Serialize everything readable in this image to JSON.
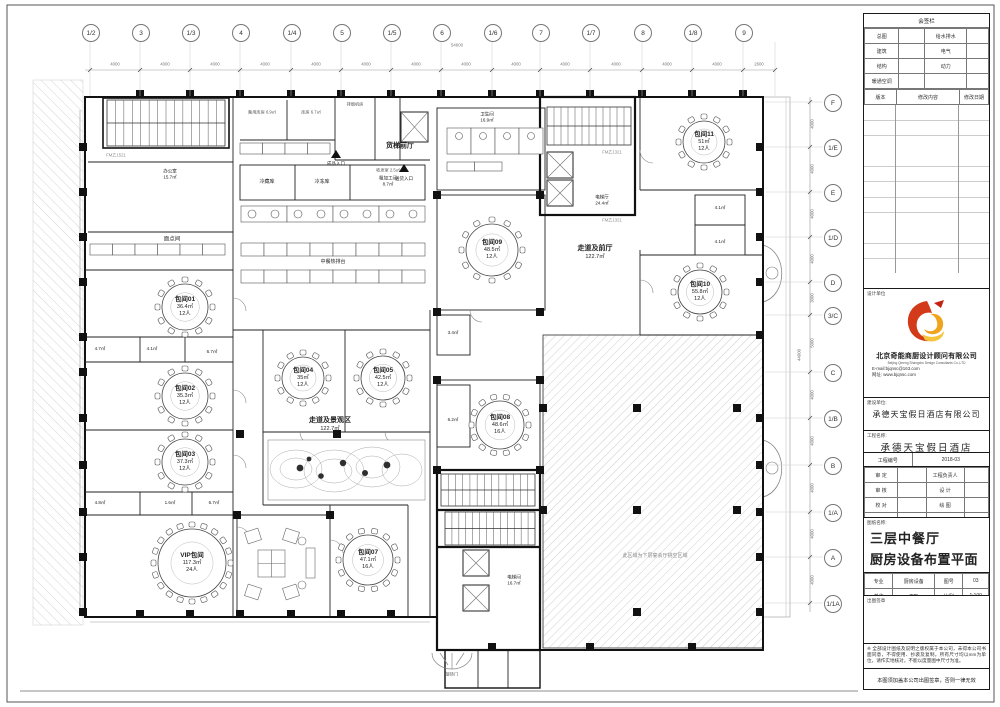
{
  "titleblock": {
    "sign": {
      "title": "会签栏",
      "rows": [
        [
          "总图",
          "给水排水"
        ],
        [
          "建筑",
          "电气"
        ],
        [
          "结构",
          "动力"
        ],
        [
          "暖通空调",
          ""
        ]
      ],
      "rev": [
        "版本",
        "修改内容",
        "修改日期"
      ]
    },
    "firm": {
      "label": "设计单位",
      "name_cn": "北京奇能商厨设计顾问有限公司",
      "name_en": "Beijing Qineng Shangchu Design Consultants Co.,LTD",
      "email": "E-mail:bjqnsc@163.com",
      "website": "网址: www.bjqnsc.com"
    },
    "client": {
      "label": "建设单位:",
      "value": "承德天宝假日酒店有限公司"
    },
    "project": {
      "label": "工程名称:",
      "value": "承德天宝假日酒店"
    },
    "project_no": {
      "label": "工程编号",
      "value": "2018-03"
    },
    "approval": {
      "rows": [
        {
          "l1": "审  定",
          "v1": "",
          "l2": "工程负责人",
          "v2": ""
        },
        {
          "l1": "审  核",
          "v1": "",
          "l2": "设  计",
          "v2": ""
        },
        {
          "l1": "校  对",
          "v1": "",
          "l2": "绘  图",
          "v2": ""
        },
        {
          "l1": "专业负责人",
          "v1": "",
          "l2": "日期",
          "v2": "2018.06.12"
        }
      ]
    },
    "sheet_name": {
      "label": "图纸名称:",
      "line1": "三层中餐厅",
      "line2": "厨房设备布置平面图"
    },
    "meta": {
      "specialty_label": "专业",
      "specialty": "厨房设备",
      "sheet_no_label": "图号",
      "sheet_no": "03",
      "unit_label": "单位",
      "unit": "mm",
      "scale_label": "比例",
      "scale": "1:100"
    },
    "stamp_label": "出图签章",
    "copyright_note": "※ 全部设计图纸及说明之版权属于本公司，未得本公司书面同意，不得使用、抄袭及复制。所有尺寸均以mm为单位，请作实地核对，不能以度量图中尺寸为准。",
    "validity_note": "本图须加盖本公司出图签章，否则一律无效"
  },
  "grid": {
    "top_bubbles": [
      "1/2",
      "3",
      "1/3",
      "4",
      "1/4",
      "5",
      "1/5",
      "6",
      "1/6",
      "7",
      "1/7",
      "8",
      "1/8",
      "9"
    ],
    "top_dims": [
      "4000",
      "4000",
      "4000",
      "4000",
      "4000",
      "4000",
      "4000",
      "4000",
      "4000",
      "4000",
      "4000",
      "4000",
      "4000",
      "2600"
    ],
    "top_total": "54600",
    "right_bubbles": [
      "F",
      "1/E",
      "E",
      "1/D",
      "D",
      "3/C",
      "C",
      "1/B",
      "B",
      "1/A",
      "A",
      "1/1A"
    ],
    "right_dims": [
      "4000",
      "4000",
      "4000",
      "4000",
      "3000",
      "5000",
      "4000",
      "4000",
      "4000",
      "4000",
      "4000"
    ],
    "right_total": "44000"
  },
  "rooms": [
    {
      "name": "包间01",
      "area": "36.4㎡",
      "cap": "12人"
    },
    {
      "name": "包间02",
      "area": "35.3㎡",
      "cap": "12人"
    },
    {
      "name": "包间03",
      "area": "37.3㎡",
      "cap": "12人"
    },
    {
      "name": "包间04",
      "area": "35㎡",
      "cap": "12人"
    },
    {
      "name": "包间05",
      "area": "42.5㎡",
      "cap": "12人"
    },
    {
      "name": "包间07",
      "area": "47.1㎡",
      "cap": "16人"
    },
    {
      "name": "包间08",
      "area": "48.6㎡",
      "cap": "16人"
    },
    {
      "name": "包间09",
      "area": "48.5㎡",
      "cap": "12人"
    },
    {
      "name": "包间10",
      "area": "55.8㎡",
      "cap": "12人"
    },
    {
      "name": "包间11",
      "area": "51㎡",
      "cap": "12人"
    },
    {
      "name": "VIP包间",
      "area": "117.3㎡",
      "cap": "24人"
    }
  ],
  "zones": {
    "garden": {
      "name": "走道及景观区",
      "area": "122.7㎡"
    },
    "foyer": {
      "name": "走道及前厅",
      "area": "122.7㎡"
    },
    "elev_hall": {
      "name": "电梯厅",
      "area": "24.4㎡"
    },
    "elev_room": {
      "name": "电梯间",
      "area": "16.7㎡"
    },
    "wc": {
      "name": "卫生间",
      "area": "16.9㎡"
    },
    "office": {
      "name": "办公室",
      "area": "15.7㎡"
    },
    "freight": "货梯前厅",
    "pastry": "面点间",
    "hotline": "中餐热排台",
    "cold1": "冷藏库",
    "cold2": "冷冻库",
    "rough": {
      "name": "粗加工间",
      "area": "8.7㎡"
    },
    "store1": "备用库房 6.9㎡",
    "store2": "库房 6.7㎡",
    "smoke": "排烟机房",
    "mail": "收发室 2.5㎡",
    "entry1": "成品入口",
    "entry2": "送货入口"
  },
  "area_tags": [
    "4.7㎡",
    "4.1㎡",
    "6.7㎡",
    "4.8㎡",
    "1.6㎡",
    "6.7㎡",
    "3.4㎡",
    "6.2㎡",
    "4.1㎡",
    "4.1㎡"
  ],
  "doors": {
    "fm1": "FM乙1521",
    "fm2": "FM乙1321"
  },
  "annotations": {
    "void_note": "此区域为下层宴会厅挑空区域",
    "revolve": "旋转门"
  }
}
